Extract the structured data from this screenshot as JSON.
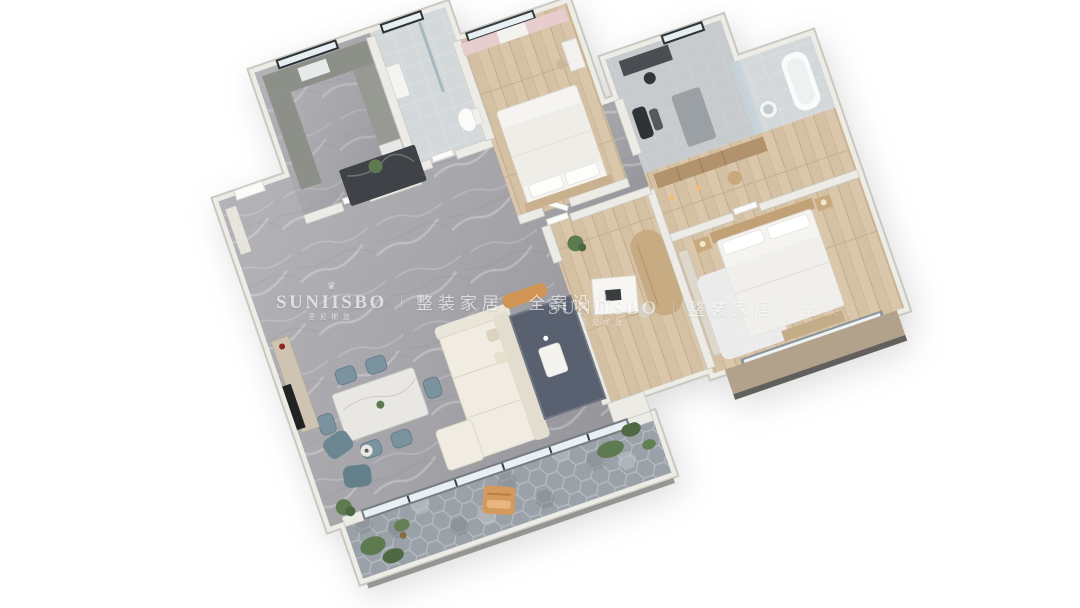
{
  "watermark": {
    "crown_icon": "♛",
    "brand": "SUNIISBO",
    "brand_cn": "圣尼斯堡",
    "divider": "|",
    "tagline": "整装家居 全案设计",
    "color": "#ffffff"
  },
  "palette": {
    "background": "#ffffff",
    "wall_light": "#edece7",
    "wall_edge": "#c9c9c2",
    "floor_marble": "#a6a6ab",
    "floor_wood": "#d9c6ab",
    "floor_tile": "#d3d8da",
    "floor_gym": "#c7cbce",
    "balcony_hex": "#9aa1a8",
    "sofa_cream": "#f0ece1",
    "chair_teal": "#7a939e",
    "armchair_teal": "#6d8792",
    "rug_slate": "#596170",
    "accent_orange": "#d29455",
    "plant_green": "#5e7a50",
    "cabinet_wood": "#b2936e",
    "counter_sage": "#8d9089",
    "island_dark": "#3f4247",
    "bay_tan": "#b2a28c",
    "curtain_pink": "#e8cdcf",
    "vase_red": "#8f261e"
  }
}
